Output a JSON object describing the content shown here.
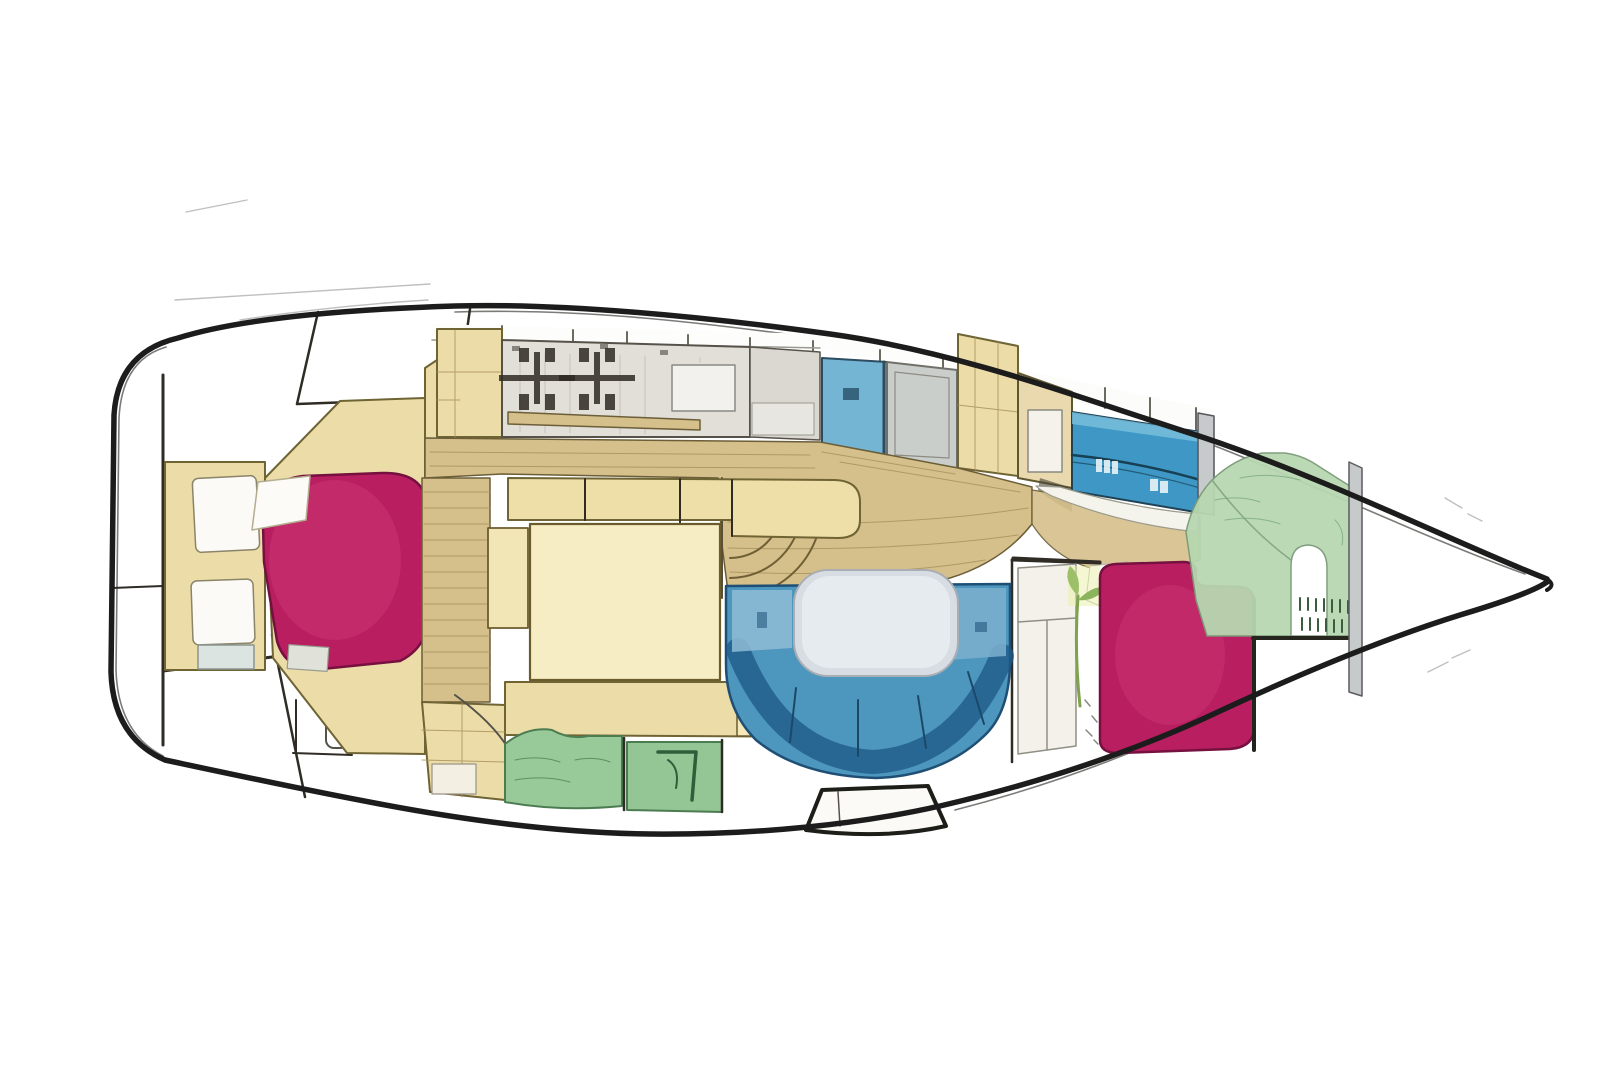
{
  "diagram": {
    "type": "boat-floor-plan",
    "subject": "Sailboat interior layout, top-down plan view, hand-drawn colored style",
    "orientation": {
      "bow": "right",
      "stern": "left"
    },
    "text_labels": [],
    "regions": [
      {
        "id": "stern-transom",
        "label": "Stern transom and cockpit lines",
        "color_key": "white_panel"
      },
      {
        "id": "aft-cabin-berth",
        "label": "Aft cabin double berth",
        "color_key": "magenta"
      },
      {
        "id": "aft-cabin-shelves",
        "label": "Aft cabin shelf unit",
        "color_key": "white_panel"
      },
      {
        "id": "galley",
        "label": "Galley counter with two-burner stove",
        "color_key": "galley_gray"
      },
      {
        "id": "head-doors",
        "label": "Head compartment doors (blue and gray)",
        "color_key": "door_blue"
      },
      {
        "id": "starboard-cabinets",
        "label": "Starboard cabinets with fridge",
        "color_key": "beige"
      },
      {
        "id": "forward-head-counter",
        "label": "Forward head counter",
        "color_key": "counter_blue"
      },
      {
        "id": "cabin-sole",
        "label": "Wood cabin sole / walkway",
        "color_key": "wood"
      },
      {
        "id": "companionway-steps",
        "label": "Companionway step ladder strip",
        "color_key": "wood"
      },
      {
        "id": "midship-table-block",
        "label": "Midship table / dinette block",
        "color_key": "pale_yellow"
      },
      {
        "id": "salon-settee",
        "label": "U-shaped salon settee",
        "color_key": "salon_blue"
      },
      {
        "id": "salon-table",
        "label": "Salon table",
        "color_key": "table_gray"
      },
      {
        "id": "wardrobe",
        "label": "Wardrobe with plant",
        "color_key": "white_panel"
      },
      {
        "id": "v-berth",
        "label": "Forward V-berth",
        "color_key": "magenta"
      },
      {
        "id": "bow-berth",
        "label": "Bow berth / sail locker",
        "color_key": "green_berth"
      },
      {
        "id": "aft-heads-seats",
        "label": "Aft heads green seats",
        "color_key": "green_seat"
      },
      {
        "id": "companionway-step",
        "label": "Companionway entry step",
        "color_key": "white_panel"
      },
      {
        "id": "mast-bulkhead",
        "label": "Mast bulkhead posts",
        "color_key": "silver"
      },
      {
        "id": "anchor-locker",
        "label": "Bow anchor locker (empty)",
        "color_key": "white_panel"
      }
    ]
  },
  "colors": {
    "hull": "#1c1c1c",
    "wall": "#2e2c24",
    "wood": "#d5bf8a",
    "wood_grain": "#a9935e",
    "beige": "#ecdca8",
    "pale_yellow": "#f7edc4",
    "galley_gray": "#e2dfd8",
    "magenta": "#b81e60",
    "magenta_edge": "#76103f",
    "magenta_highlight": "#d6447f",
    "salon_blue": "#4d96bd",
    "salon_blue_dark": "#1d5a88",
    "salon_blue_light": "#8fbcd6",
    "table_gray": "#d7dde3",
    "counter_blue": "#3e97c4",
    "door_blue": "#74b5d3",
    "door_gray": "#caceca",
    "green_seat": "#98c999",
    "green_seat_dark": "#4c7c52",
    "green_berth": "#b7d7b0",
    "silver": "#c6caca",
    "white_panel": "#f3f1e9",
    "sketch": "#2f2b24"
  }
}
